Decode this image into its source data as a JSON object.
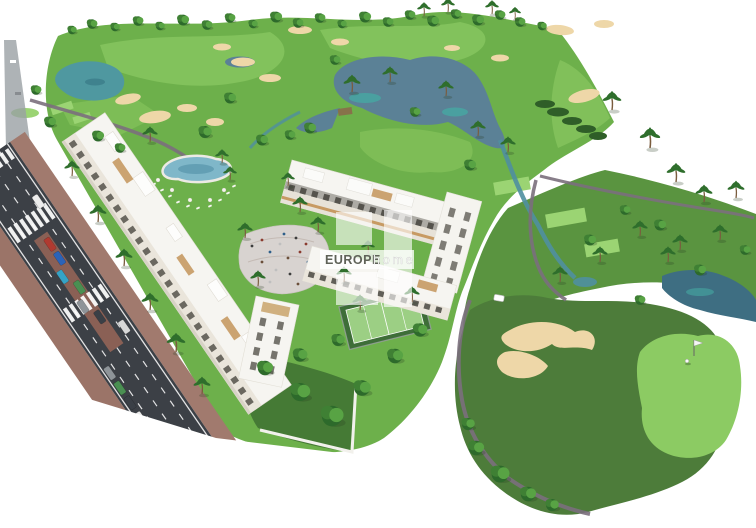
{
  "watermark": {
    "logo_name": "europe-home-logo",
    "brand_primary": "EUROPE",
    "brand_secondary": "home"
  },
  "palette": {
    "background": "#ffffff",
    "grass_base": "#6db04b",
    "grass_light": "#85c45e",
    "rough_green": "#5a9440",
    "fairway_dark": "#4d7c3a",
    "putting_green": "#8ccb63",
    "tee_green": "#9bd473",
    "sand_bunker": "#eed7a8",
    "lake_water": "#5b8196",
    "lake_teal": "#46a8a2",
    "pond_dark": "#3e6e82",
    "pool_water": "#7fb7c9",
    "walk_path": "#7b6f7d",
    "plaza_paving": "#d8d3d0",
    "road_asphalt": "#3c4046",
    "sidewalk": "#9b7468",
    "median": "#8a6055",
    "building_white": "#f6f5f1",
    "building_facade": "#eae5db",
    "window_dark": "#4c4a42",
    "wood_pergola": "#c79a63",
    "tree_dark": "#2d6a2b",
    "tree_light": "#58a344",
    "watermark_white": "rgba(255,255,255,0.62)"
  }
}
